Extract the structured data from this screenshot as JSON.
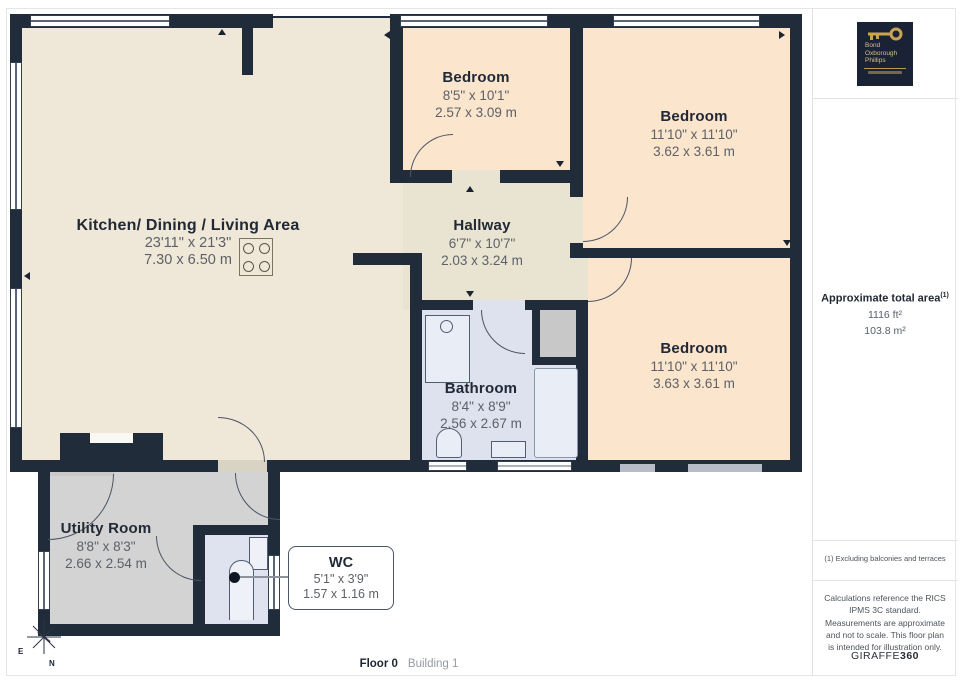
{
  "rooms": {
    "kitchen": {
      "name": "Kitchen/ Dining / Living Area",
      "imperial": "23'11\" x 21'3\"",
      "metric": "7.30 x 6.50 m"
    },
    "bedroom1": {
      "name": "Bedroom",
      "imperial": "8'5\" x 10'1\"",
      "metric": "2.57 x 3.09 m"
    },
    "bedroom2": {
      "name": "Bedroom",
      "imperial": "11'10\" x 11'10\"",
      "metric": "3.62 x 3.61 m"
    },
    "hallway": {
      "name": "Hallway",
      "imperial": "6'7\" x 10'7\"",
      "metric": "2.03 x 3.24 m"
    },
    "bathroom": {
      "name": "Bathroom",
      "imperial": "8'4\" x 8'9\"",
      "metric": "2.56 x 2.67 m"
    },
    "bedroom3": {
      "name": "Bedroom",
      "imperial": "11'10\" x 11'10\"",
      "metric": "3.63 x 3.61 m"
    },
    "utility": {
      "name": "Utility Room",
      "imperial": "8'8\" x 8'3\"",
      "metric": "2.66 x 2.54 m"
    },
    "wc": {
      "name": "WC",
      "imperial": "5'1\" x 3'9\"",
      "metric": "1.57 x 1.16 m"
    }
  },
  "sidebar": {
    "logo": {
      "line1": "Bond",
      "line2": "Oxborough",
      "line3": "Phillips"
    },
    "area": {
      "title": "Approximate total area",
      "superscript": "(1)",
      "imperial": "1116 ft²",
      "metric": "103.8 m²"
    },
    "footnote": "(1) Excluding balconies and terraces",
    "disclaimer": "Calculations reference the RICS IPMS 3C standard. Measurements are approximate and not to scale. This floor plan is intended for illustration only.",
    "brand": {
      "prefix": "GIRAFFE",
      "suffix": "360"
    }
  },
  "footer": {
    "floor": "Floor 0",
    "building": "Building 1"
  },
  "compass": {
    "east": "E",
    "north": "N"
  },
  "colors": {
    "wall": "#212c3a",
    "kitchen_floor": "#efe8d8",
    "hallway_floor": "#e9e4d2",
    "bedroom_floor": "#fce5cd",
    "bathroom_floor": "#dde2ee",
    "utility_floor": "#d3d3d3",
    "cupboard": "#c8c8c8"
  }
}
